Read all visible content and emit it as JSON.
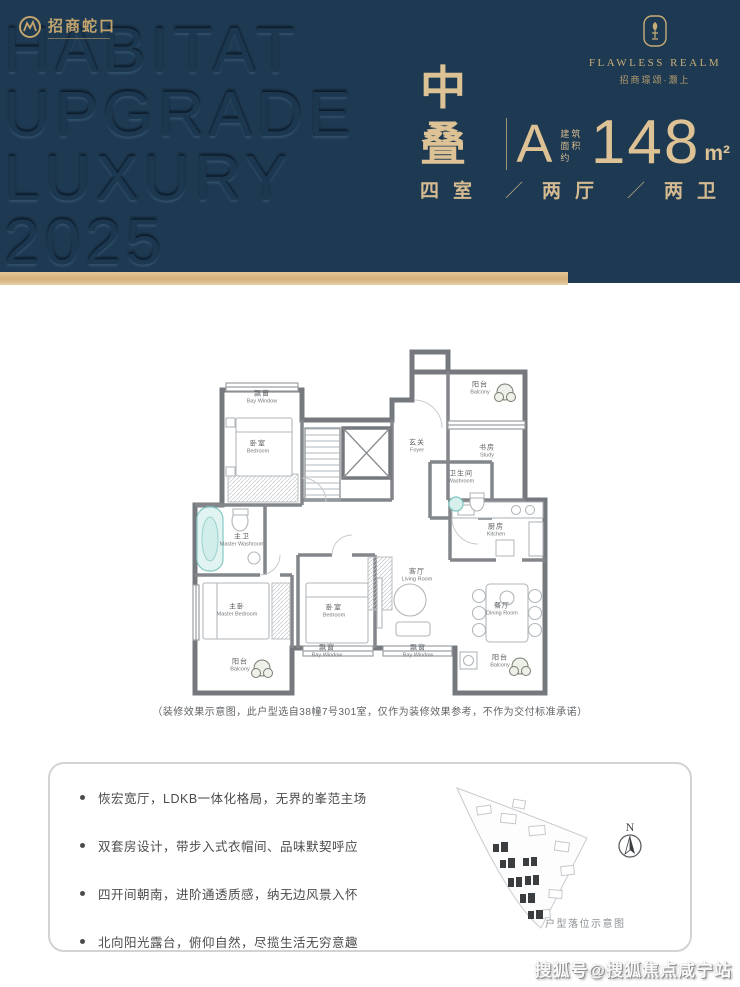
{
  "header": {
    "brand": {
      "name": "招商蛇口"
    },
    "embossed_lines": [
      "HABITAT",
      "UPGRADE",
      "LUXURY",
      "2025"
    ],
    "project_logo": {
      "title": "FLAWLESS REALM",
      "subtitle": "招商璟颂·灏上"
    },
    "unit": {
      "type": "中叠",
      "plan_letter": "A",
      "area_prefix_lines": [
        "建筑",
        "面积约"
      ],
      "area_value": "148",
      "area_unit": "m²",
      "layout_rooms": "四室",
      "layout_halls": "两厅",
      "layout_baths": "两卫",
      "separator": "／"
    }
  },
  "floor_plan": {
    "rooms": [
      {
        "zh": "飘窗",
        "en": "Bay Window"
      },
      {
        "zh": "卧室",
        "en": "Bedroom"
      },
      {
        "zh": "阳台",
        "en": "Balcony"
      },
      {
        "zh": "书房",
        "en": "Study"
      },
      {
        "zh": "玄关",
        "en": "Foyer"
      },
      {
        "zh": "卫生间",
        "en": "Washroom"
      },
      {
        "zh": "厨房",
        "en": "Kitchen"
      },
      {
        "zh": "主卫",
        "en": "Master Washroom"
      },
      {
        "zh": "主卧",
        "en": "Master Bedroom"
      },
      {
        "zh": "卧室",
        "en": "Bedroom"
      },
      {
        "zh": "飘窗",
        "en": "Bay Window"
      },
      {
        "zh": "客厅",
        "en": "Living Room"
      },
      {
        "zh": "餐厅",
        "en": "Dining Room"
      },
      {
        "zh": "阳台",
        "en": "Balcony"
      },
      {
        "zh": "飘窗",
        "en": "Bay Window"
      },
      {
        "zh": "阳台",
        "en": "Balcony"
      }
    ],
    "caption": "（装修效果示意图，此户型选自38幢7号301室，仅作为装修效果参考，不作为交付标准承诺）"
  },
  "features": {
    "bullets": [
      "恢宏宽厅，LDKB一体化格局，无界的峯范主场",
      "双套房设计，带步入式衣帽间、品味默契呼应",
      "四开间朝南，进阶通透质感，纳无边风景入怀",
      "北向阳光露台，俯仰自然，尽揽生活无穷意趣"
    ]
  },
  "site_plan": {
    "compass_label": "N",
    "caption": "户型落位示意图"
  },
  "watermark": "搜狐号@搜狐焦点咸宁站",
  "colors": {
    "navy": "#1e3a52",
    "gold": "#d7bd8f",
    "gold_bar": "#d9b886",
    "teal": "#8fd0cc"
  }
}
